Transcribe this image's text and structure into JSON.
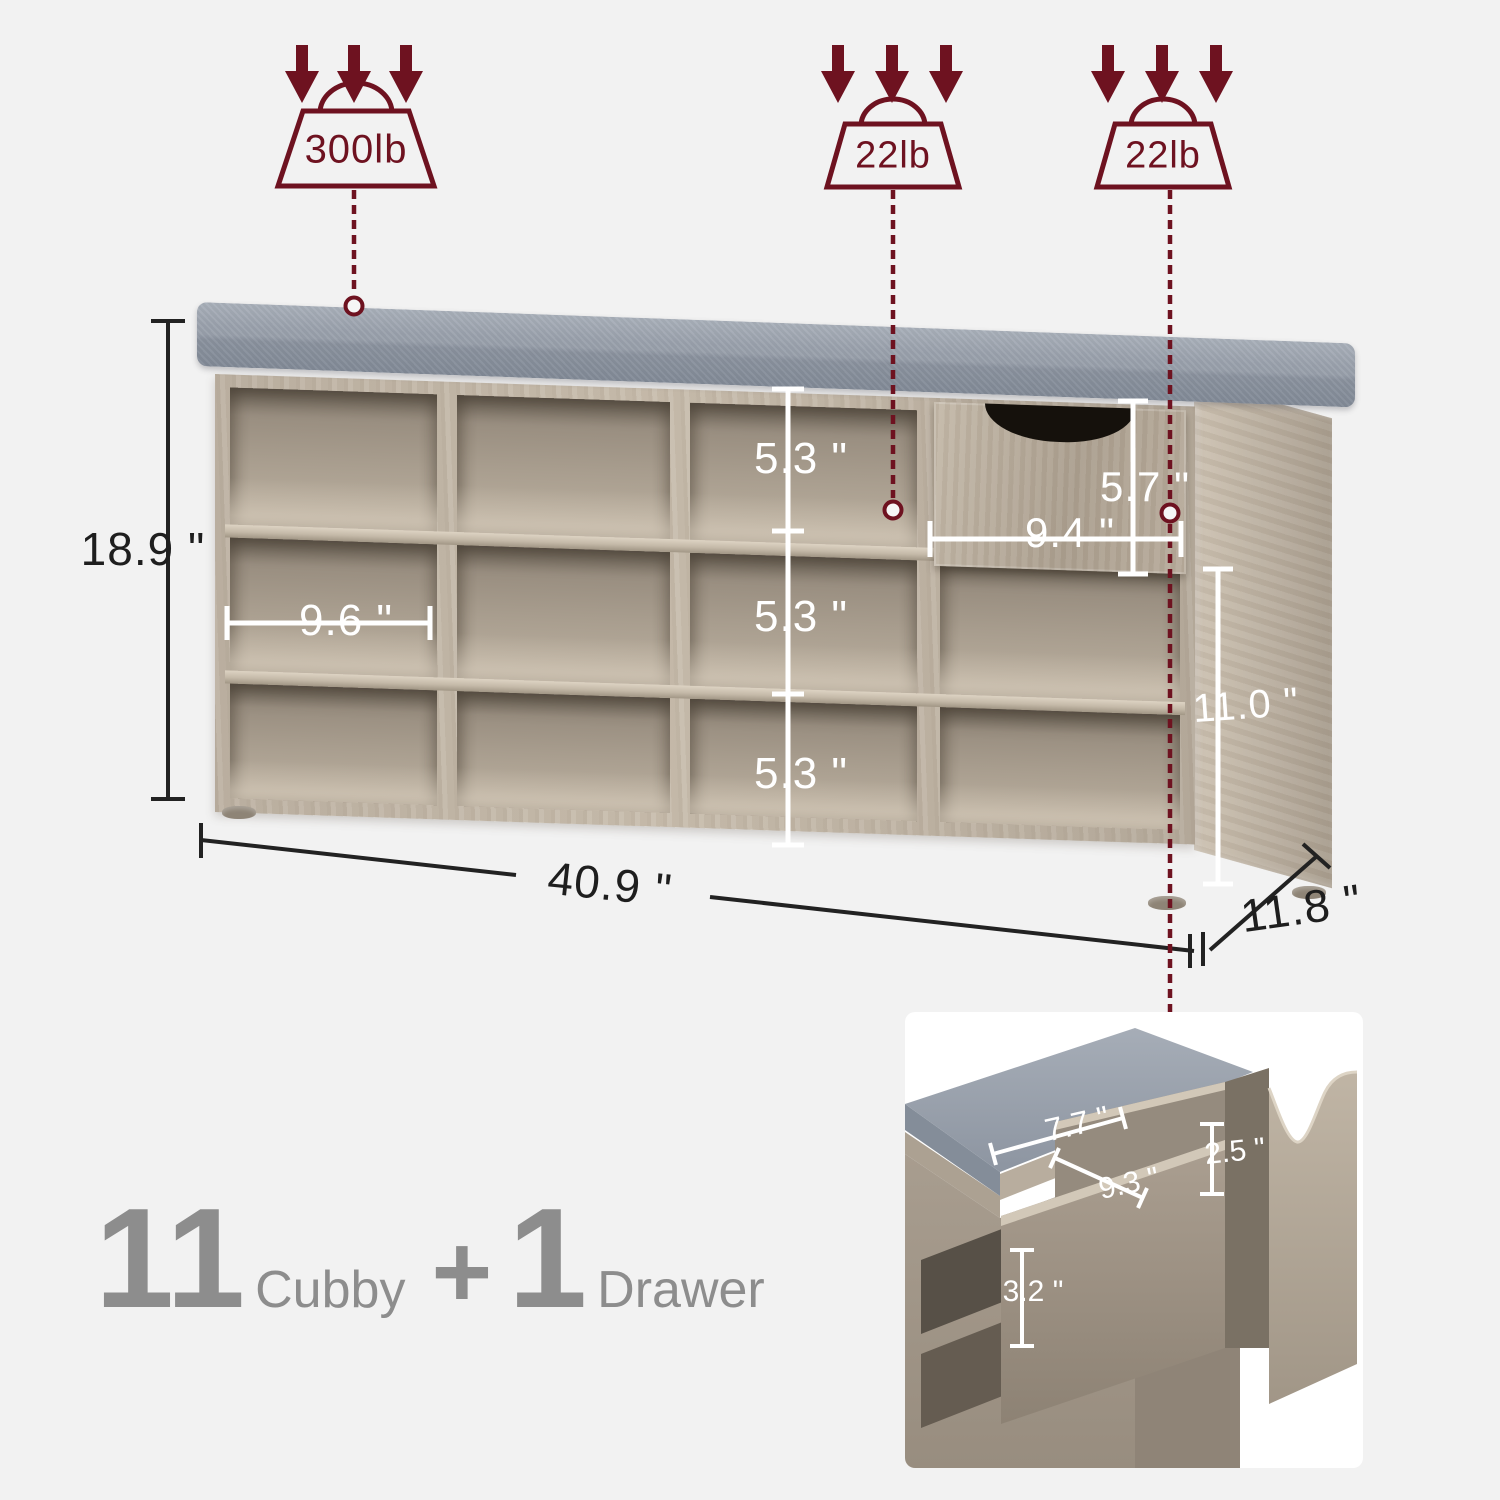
{
  "colors": {
    "background": "#f2f2f2",
    "accent_dark_red": "#6e1220",
    "wood": "#b5aa9b",
    "cushion_gray": "#99a1ab",
    "caption_gray": "#8d8d8d",
    "dimension_black": "#1e1e1e",
    "dimension_white": "#ffffff"
  },
  "weights": [
    {
      "icon": "triple-down-arrows-and-weight",
      "label": "300lb"
    },
    {
      "icon": "triple-down-arrows-and-weight",
      "label": "22lb"
    },
    {
      "icon": "triple-down-arrows-and-weight",
      "label": "22lb"
    }
  ],
  "dimensions": {
    "overall_height": "18.9 \"",
    "overall_width": "40.9 \"",
    "overall_depth": "11.8 \"",
    "right_section_height": "11.0 \"",
    "cubby_width": "9.6 \"",
    "cubby_heights": [
      "5.3 \"",
      "5.3 \"",
      "5.3 \""
    ],
    "drawer_front_width": "9.4 \"",
    "drawer_front_height": "5.7 \""
  },
  "drawer_inset": {
    "inner_width": "7.7 \"",
    "inner_depth": "9.3 \"",
    "notch_height": "2.5 \"",
    "inner_height": "3.2 \""
  },
  "caption": {
    "cubby_count": "11",
    "cubby_word": "Cubby",
    "plus_sign": "+",
    "drawer_count": "1",
    "drawer_word": "Drawer"
  }
}
